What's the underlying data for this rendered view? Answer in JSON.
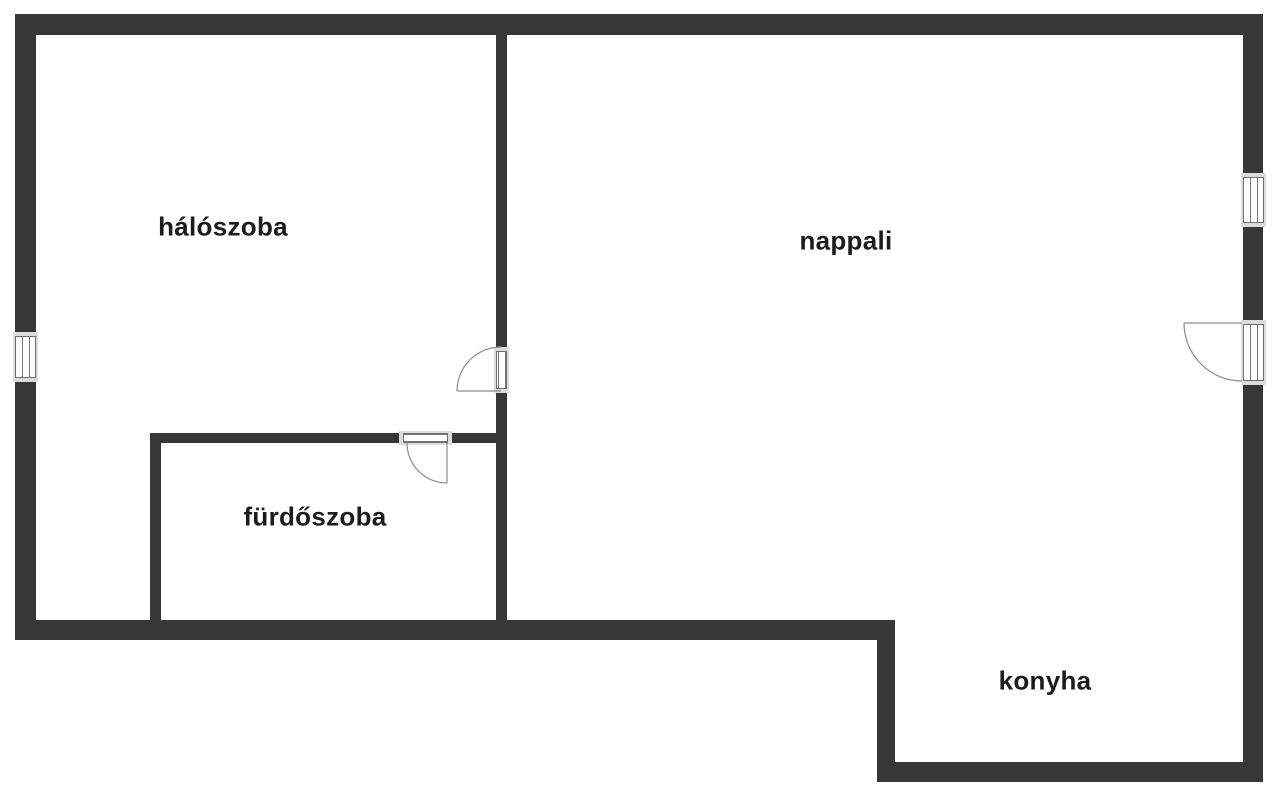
{
  "plan": {
    "type": "floor-plan",
    "rooms": [
      {
        "id": "haloszoba",
        "label": "hálószoba"
      },
      {
        "id": "nappali",
        "label": "nappali"
      },
      {
        "id": "furdoszoba",
        "label": "fürdőszoba"
      },
      {
        "id": "konyha",
        "label": "konyha"
      }
    ],
    "features": {
      "windows": 2,
      "doors": 3
    },
    "palette": {
      "wall": "#373737",
      "label_text": "#1c1c1c",
      "door_swing_line": "#8c8c8c",
      "window_frame": "#dcdcdc",
      "window_pane_border": "#6e6e6e",
      "background": "#ffffff"
    }
  }
}
